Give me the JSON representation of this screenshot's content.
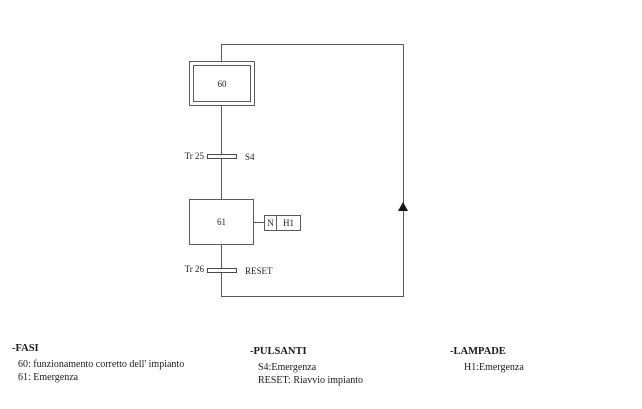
{
  "diagram": {
    "initial_step": {
      "id": "60"
    },
    "step": {
      "id": "61"
    },
    "transitions": [
      {
        "name": "Tr 25",
        "condition": "S4"
      },
      {
        "name": "Tr 26",
        "condition": "RESET"
      }
    ],
    "action": {
      "qualifier": "N",
      "variable": "H1"
    }
  },
  "legend": {
    "fasi": {
      "title": "-FASI",
      "items": [
        "60: funzionamento corretto dell' impianto",
        "61: Emergenza"
      ]
    },
    "pulsanti": {
      "title": "-PULSANTI",
      "items": [
        "S4:Emergenza",
        "RESET: Riavvio impianto"
      ]
    },
    "lampade": {
      "title": "-LAMPADE",
      "items": [
        "H1:Emergenza"
      ]
    }
  },
  "colors": {
    "line": "#5a5a5a",
    "text": "#222222",
    "arrow": "#151515",
    "background": "#ffffff"
  }
}
